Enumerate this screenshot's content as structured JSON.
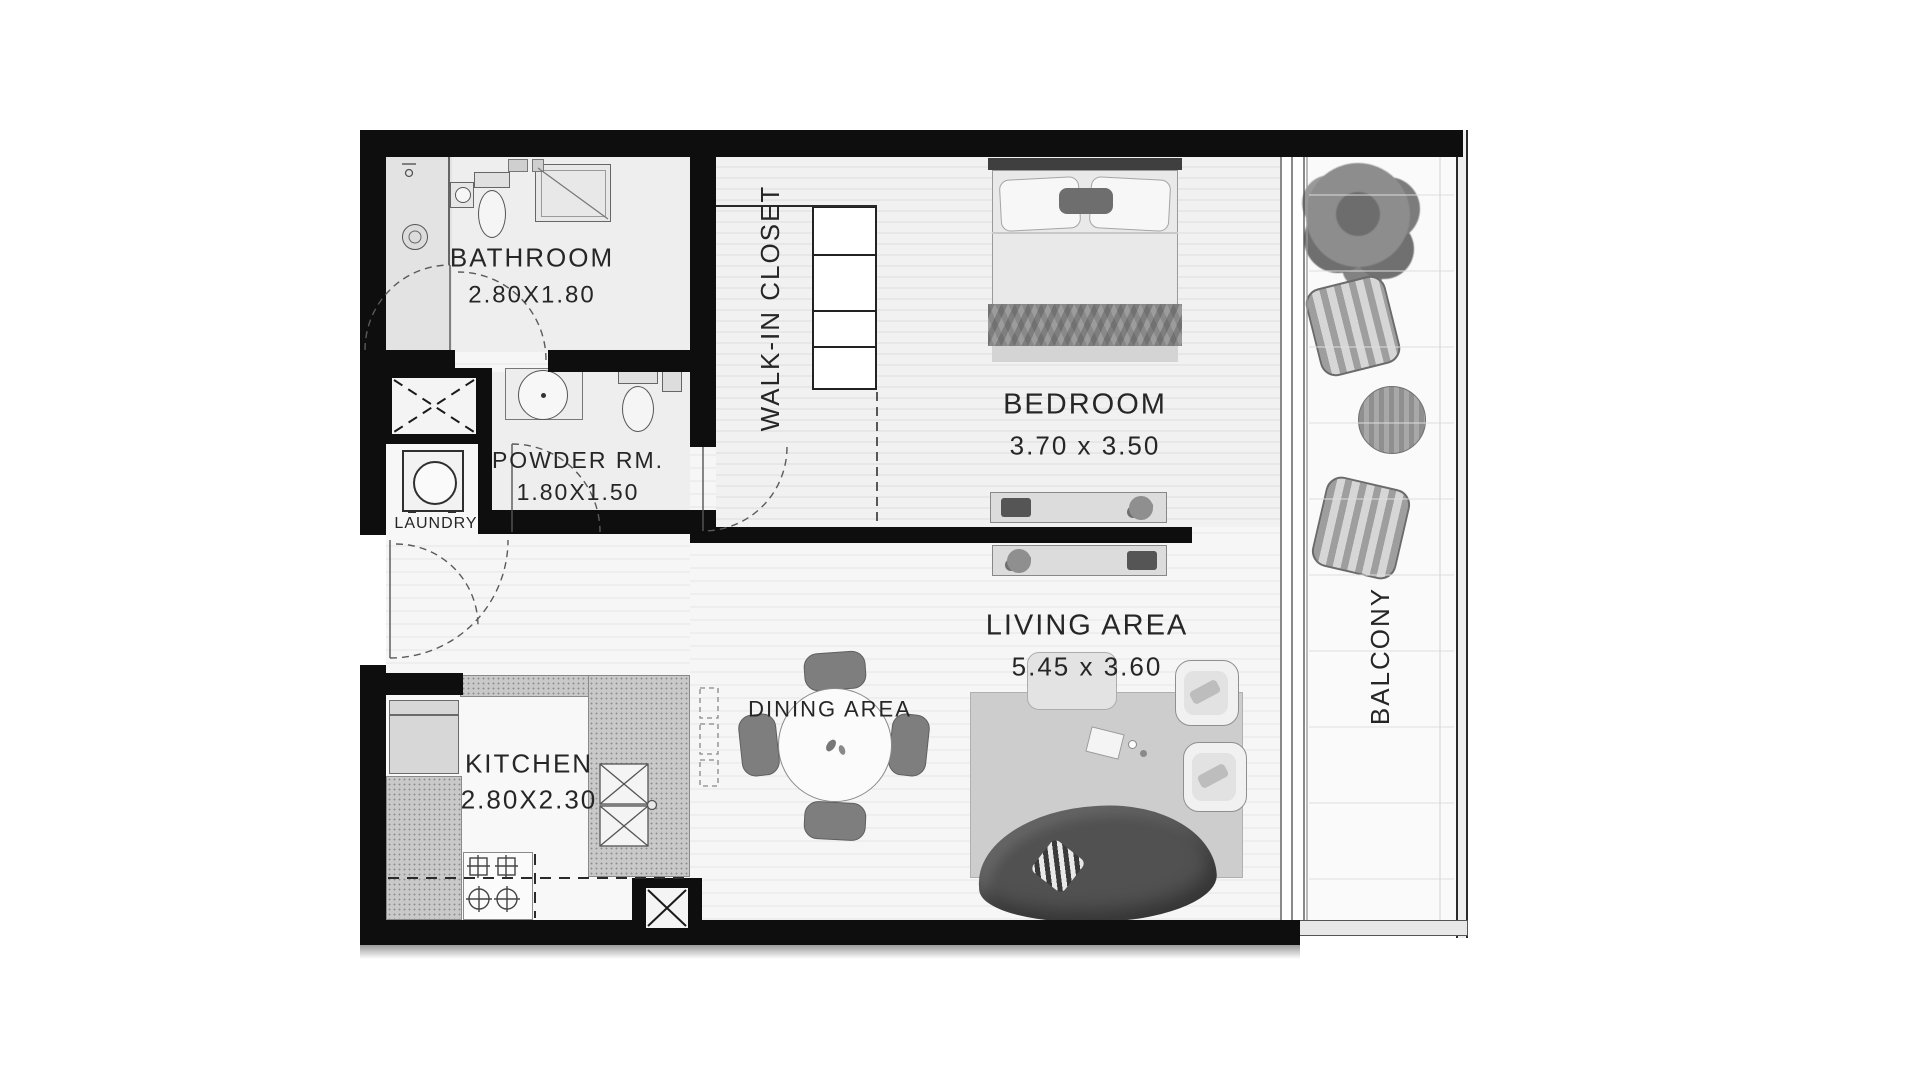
{
  "rooms": {
    "bathroom": {
      "label": "BATHROOM",
      "dims": "2.80X1.80"
    },
    "powder": {
      "label": "POWDER RM.",
      "dims": "1.80X1.50"
    },
    "laundry": {
      "label": "LAUNDRY"
    },
    "walkin": {
      "label": "WALK-IN CLOSET"
    },
    "bedroom": {
      "label": "BEDROOM",
      "dims": "3.70 x 3.50"
    },
    "living": {
      "label": "LIVING AREA",
      "dims": "5.45 x 3.60"
    },
    "dining": {
      "label": "DINING AREA"
    },
    "kitchen": {
      "label": "KITCHEN",
      "dims": "2.80X2.30"
    },
    "balcony": {
      "label": "BALCONY"
    }
  },
  "colors": {
    "wall": "#0e0e0e",
    "label_text": "#262626",
    "floor_light": "#f1f1f1",
    "counter_gray": "#c9c9c9",
    "sofa_dark": "#515151",
    "rug_gray": "#cdcdcd"
  }
}
